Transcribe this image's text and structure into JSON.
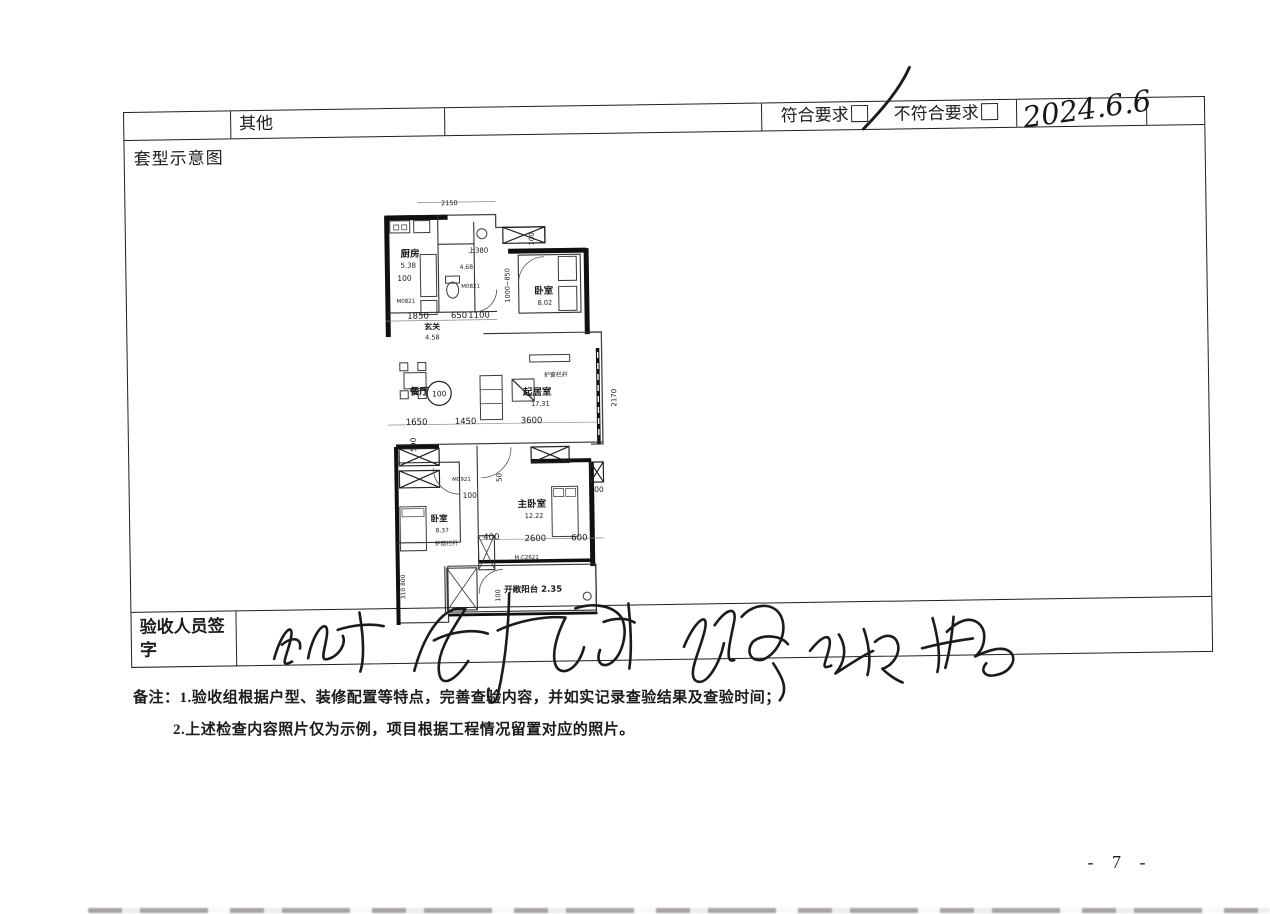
{
  "header_row": {
    "other_label": "其他",
    "compliant_label": "符合要求",
    "noncompliant_label": "不符合要求",
    "handwritten_date": "2024.6.6"
  },
  "plan_section": {
    "title": "套型示意图"
  },
  "signature_row": {
    "label_line1": "验收人员签",
    "label_line2": "字"
  },
  "notes": {
    "line1": "备注：1.验收组根据户型、装修配置等特点，完善查验内容，并如实记录查验结果及查验时间；",
    "line2": "2.上述检查内容照片仅为示例，项目根据工程情况留置对应的照片。"
  },
  "page": {
    "number": "- 7 -"
  },
  "floorplan": {
    "rooms": {
      "kitchen": {
        "name": "厨房",
        "area": "5.38"
      },
      "entry": {
        "name": "玄关",
        "area": "4.58"
      },
      "bedroom_top": {
        "name": "卧室",
        "area": "8.02"
      },
      "dining": {
        "name": "餐厅"
      },
      "living": {
        "name": "起居室",
        "area": "17.31"
      },
      "bedroom_left": {
        "name": "卧室",
        "area": "8.37"
      },
      "master_bedroom": {
        "name": "主卧室",
        "area": "12.22"
      },
      "balcony": {
        "name": "开敞阳台 2.35"
      }
    },
    "dims": {
      "top": "2150",
      "up_step": "上380",
      "bath_area": "4.68",
      "hall_w1": "1850",
      "hall_w2": "650",
      "hall_w3": "1100",
      "k100": "100",
      "door_k": "M0821",
      "door_b": "M0821",
      "door_m": "M0921",
      "win_m": "M.C2621",
      "shaft_v": "100",
      "bed_v": "1000~850",
      "dining_w1": "1650",
      "dining_w2": "1450",
      "living_w": "3600",
      "v590": "590",
      "v2170": "2170",
      "v700": "700",
      "mid100": "100",
      "v50": "50",
      "master_w1": "2600",
      "master_w2": "600",
      "master_w3": "400",
      "guard1": "护窗栏杆",
      "guard2": "护窗栏杆",
      "left_v": "310 800",
      "bal100": "100",
      "circle100": "100"
    }
  }
}
